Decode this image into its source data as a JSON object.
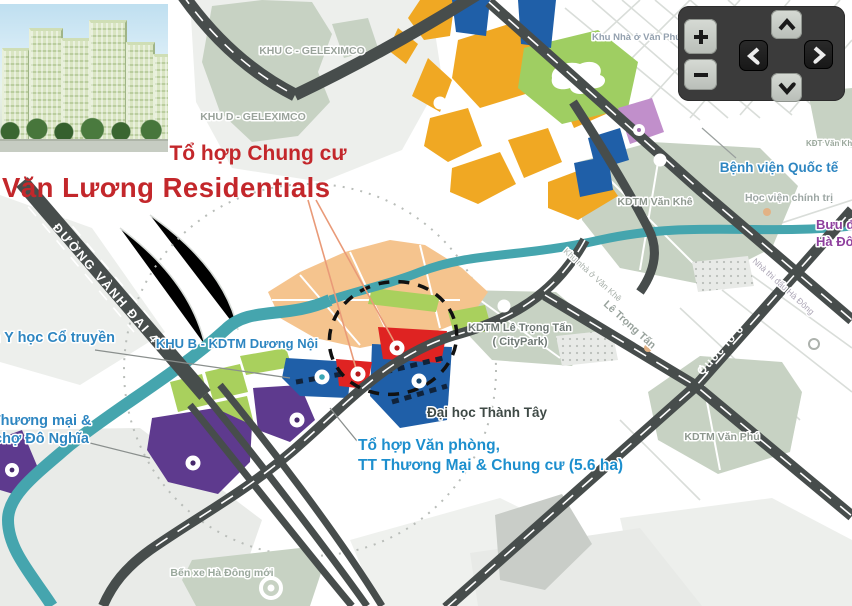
{
  "title": {
    "subtitle": "Tổ hợp Chung cư",
    "main": "Văn Lương Residentials"
  },
  "photo_alt": "Văn Lương Residentials apartment complex rendering",
  "nav": {
    "zoom_in_icon": "plus",
    "zoom_out_icon": "minus",
    "pan_up_icon": "chevron-up",
    "pan_down_icon": "chevron-down",
    "pan_left_icon": "chevron-left",
    "pan_right_icon": "chevron-right"
  },
  "colors": {
    "accent_red": "#C3272B",
    "label_blue": "#2E86C1",
    "label_purple": "#8E3F9E",
    "road_dark": "#474D4C",
    "canal_teal": "#45A5AE",
    "zone_yellow": "#F0A823",
    "zone_tan": "#F5C48E",
    "zone_blue": "#1F5FA8",
    "zone_red": "#DF2322",
    "zone_purple": "#5E3A8E",
    "zone_lilac": "#C18FCB",
    "zone_lime": "#A9D05D",
    "zone_sage": "#C7D2C3"
  },
  "map": {
    "labels": {
      "khu_c": "KHU C - GELEXIMCO",
      "khu_d": "KHU D - GELEXIMCO",
      "khu_van_phu_top": "Khu Nhà ở Văn Phú",
      "kdt_top_right": "KĐT Văn Khê",
      "kdtm_van_khe": "KDTM Văn Khê",
      "benh_vien": "Bệnh viện Quốc tế",
      "hoc_vien": "Học viện chính trị",
      "buu_dien_1": "Bưu điện",
      "buu_dien_2": "Hà Đông",
      "khu_b": "KHU B - KDTM Dương Nội",
      "vien_y_hoc": "Viện Y học Cổ truyền",
      "tt_thuong_mai_1": "TT Thương mại &",
      "tt_thuong_mai_2": "chợ Đô Nghĩa",
      "le_trong_tan_zone_1": "KDTM Lê Trọng Tấn",
      "le_trong_tan_zone_2": "( CityPark)",
      "dai_hoc": "Đại học Thành Tây",
      "office_1": "Tổ hợp Văn phòng,",
      "office_2": "TT Thương Mại & Chung cư (5.6 ha)",
      "kdtm_van_phu": "KDTM Văn Phú",
      "ben_xe": "Bến xe Hà Đông mới",
      "road_vanh_dai_4": "ĐƯỜNG VÀNH ĐAI 4",
      "road_quoc_lo_6": "Quốc lộ 6",
      "road_le_trong_tan": "Lê Trọng Tấn",
      "khu_nha_o_van_khe": "Khu nhà ở Văn Khê",
      "nha_thi_dau": "Nhà thi đấu Hà Đông"
    }
  }
}
